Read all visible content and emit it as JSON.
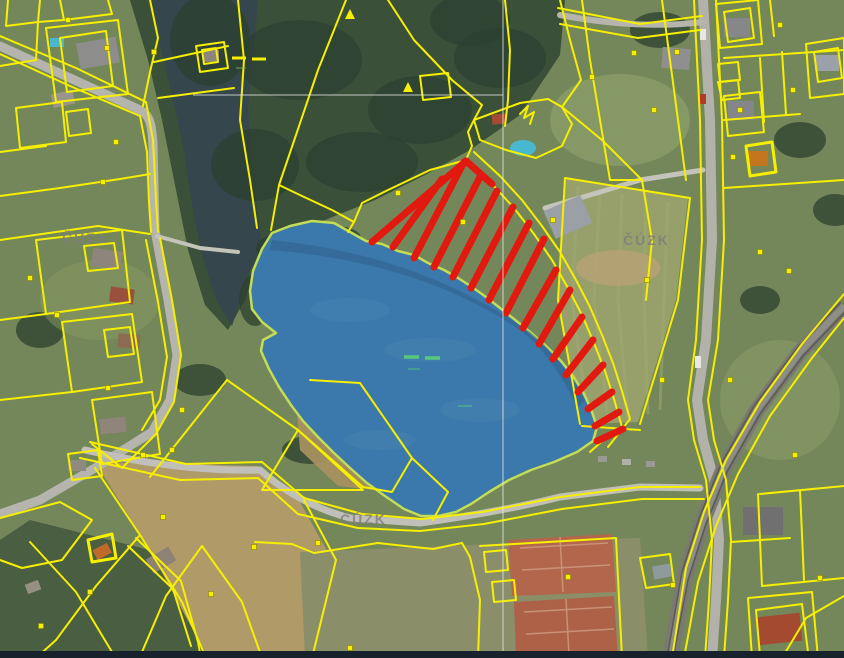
{
  "app": {
    "name": "cadastral-map-aerial-view"
  },
  "watermark": {
    "text": "ČÚZK",
    "color": "#7e7e7e",
    "count": 3
  },
  "colors": {
    "parcel_line": "#f6ef00",
    "highlight_water_fill": "#3b78ab",
    "highlight_water_edge": "#c3dd54",
    "selection_hatch": "#e2190f",
    "water_symbol_green": "#56c97e",
    "water_symbol_yellow": "#f6ef00",
    "sheet_line": "#e8e8e8",
    "map_edge_strip": "#18222c",
    "watermark": "#7e7e7e"
  },
  "symbols": {
    "upper_pond_water_dashes": "– –",
    "lower_pond_water_dashes": "– –",
    "parcel_marker": "▪",
    "scrub_triangle": "▲"
  }
}
